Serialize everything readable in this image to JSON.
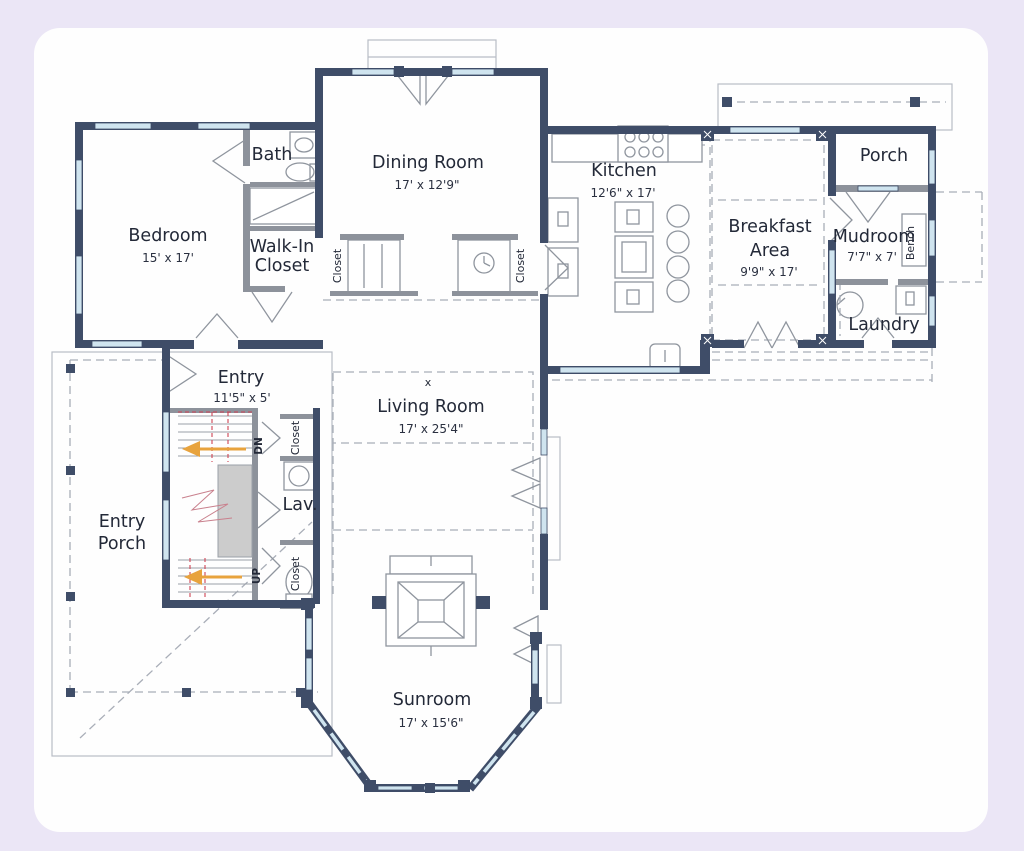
{
  "page": {
    "background": "#ebe6f6",
    "panel_background": "#fefefe"
  },
  "colors": {
    "wall": "#3f4d68",
    "window": "#cfe4ef",
    "partition": "#8d929b",
    "dashed_line": "#a9aeb8",
    "stair_arrow": "#e8a33d",
    "stair_rail": "#cf4354",
    "text": "#232938"
  },
  "rooms": {
    "bedroom": {
      "name": "Bedroom",
      "dims": "15' x 17'"
    },
    "bath": {
      "name": "Bath"
    },
    "walkin": {
      "line1": "Walk-In",
      "line2": "Closet"
    },
    "dining": {
      "name": "Dining Room",
      "dims": "17' x 12'9\""
    },
    "kitchen": {
      "name": "Kitchen",
      "dims": "12'6\" x 17'"
    },
    "breakfast": {
      "line1": "Breakfast",
      "line2": "Area",
      "dims": "9'9\" x 17'"
    },
    "porch": {
      "name": "Porch"
    },
    "mudroom": {
      "name": "Mudroom",
      "dims": "7'7\" x 7'"
    },
    "bench": {
      "name": "Bench"
    },
    "laundry": {
      "name": "Laundry"
    },
    "entry": {
      "name": "Entry",
      "dims": "11'5\" x 5'"
    },
    "living": {
      "name": "Living Room",
      "dims": "17' x 25'4\"",
      "center_mark": "x"
    },
    "entry_porch": {
      "line1": "Entry",
      "line2": "Porch"
    },
    "sunroom": {
      "name": "Sunroom",
      "dims": "17' x 15'6\""
    },
    "lav": {
      "name": "Lav."
    },
    "closet_label": "Closet"
  },
  "stairs": {
    "down_label": "DN",
    "up_label": "UP"
  }
}
